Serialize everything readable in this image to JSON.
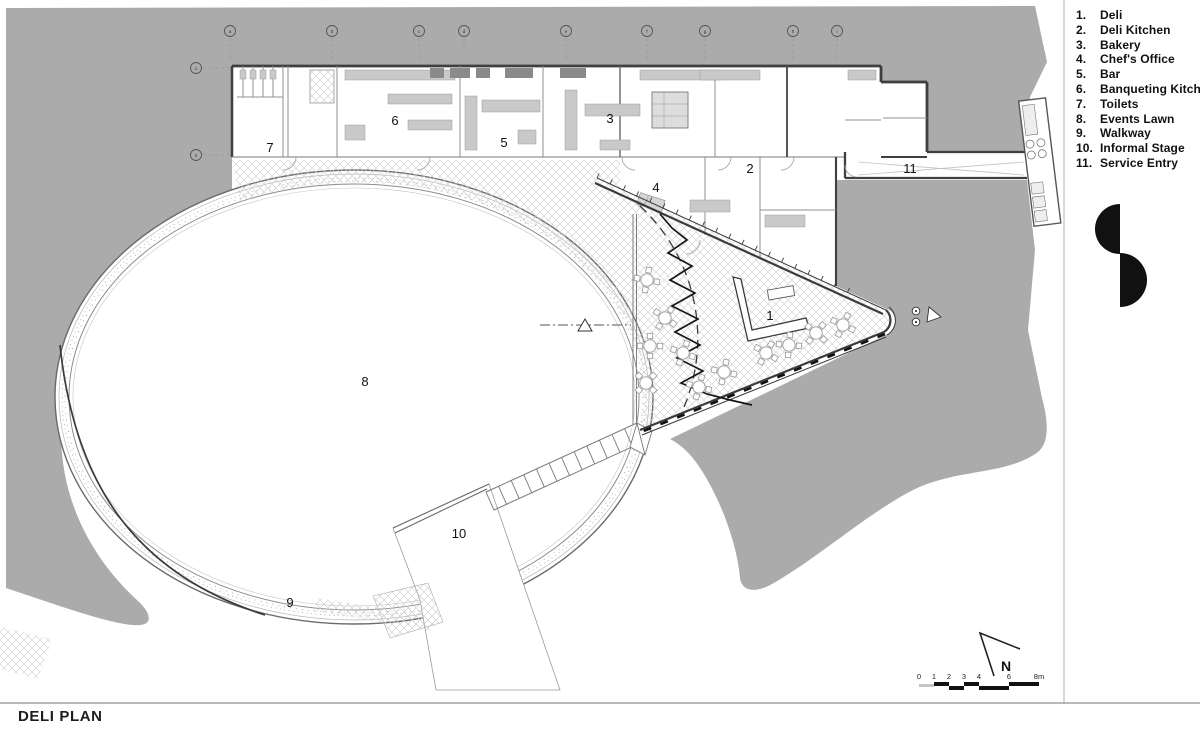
{
  "title": "DELI PLAN",
  "legend": {
    "items": [
      {
        "num": "1.",
        "label": "Deli"
      },
      {
        "num": "2.",
        "label": "Deli Kitchen"
      },
      {
        "num": "3.",
        "label": "Bakery"
      },
      {
        "num": "4.",
        "label": "Chef's Office"
      },
      {
        "num": "5.",
        "label": "Bar"
      },
      {
        "num": "6.",
        "label": "Banqueting Kitchen"
      },
      {
        "num": "7.",
        "label": "Toilets"
      },
      {
        "num": "8.",
        "label": "Events Lawn"
      },
      {
        "num": "9.",
        "label": "Walkway"
      },
      {
        "num": "10.",
        "label": "Informal Stage"
      },
      {
        "num": "11.",
        "label": "Service Entry"
      }
    ]
  },
  "plan": {
    "room_labels": [
      {
        "text": "1",
        "x": 770,
        "y": 320
      },
      {
        "text": "2",
        "x": 750,
        "y": 173
      },
      {
        "text": "3",
        "x": 610,
        "y": 123
      },
      {
        "text": "4",
        "x": 656,
        "y": 192
      },
      {
        "text": "5",
        "x": 504,
        "y": 147
      },
      {
        "text": "6",
        "x": 395,
        "y": 125
      },
      {
        "text": "7",
        "x": 270,
        "y": 152
      },
      {
        "text": "8",
        "x": 365,
        "y": 386
      },
      {
        "text": "9",
        "x": 290,
        "y": 607
      },
      {
        "text": "10",
        "x": 459,
        "y": 538
      },
      {
        "text": "11",
        "x": 910,
        "y": 173
      }
    ],
    "grid_top": [
      {
        "label": "a",
        "x": 230
      },
      {
        "label": "b",
        "x": 332
      },
      {
        "label": "c",
        "x": 419
      },
      {
        "label": "d",
        "x": 464
      },
      {
        "label": "e",
        "x": 566
      },
      {
        "label": "f",
        "x": 647
      },
      {
        "label": "g",
        "x": 705
      },
      {
        "label": "h",
        "x": 793
      },
      {
        "label": "i",
        "x": 837
      }
    ],
    "grid_left": [
      {
        "label": "1",
        "y": 68
      },
      {
        "label": "2",
        "y": 155
      }
    ],
    "tables": [
      {
        "x": 647,
        "y": 280,
        "r": 10
      },
      {
        "x": 665,
        "y": 318,
        "r": 35
      },
      {
        "x": 650,
        "y": 346,
        "r": 0
      },
      {
        "x": 683,
        "y": 353,
        "r": 20
      },
      {
        "x": 646,
        "y": 383,
        "r": 45
      },
      {
        "x": 699,
        "y": 387,
        "r": 15
      },
      {
        "x": 766,
        "y": 353,
        "r": 30
      },
      {
        "x": 789,
        "y": 345,
        "r": 5
      },
      {
        "x": 816,
        "y": 333,
        "r": 40
      },
      {
        "x": 843,
        "y": 325,
        "r": 25
      },
      {
        "x": 724,
        "y": 372,
        "r": 12
      }
    ]
  },
  "north_arrow": {
    "label": "N"
  },
  "scale_bar": {
    "ticks": [
      {
        "t": "0",
        "x": 919
      },
      {
        "t": "1",
        "x": 934
      },
      {
        "t": "2",
        "x": 949
      },
      {
        "t": "3",
        "x": 964
      },
      {
        "t": "4",
        "x": 979
      },
      {
        "t": "6",
        "x": 1009
      },
      {
        "t": "8m",
        "x": 1039
      }
    ]
  },
  "colors": {
    "site_gray": "#ababab",
    "wall": "#3f3f3f",
    "ink": "#111111"
  }
}
